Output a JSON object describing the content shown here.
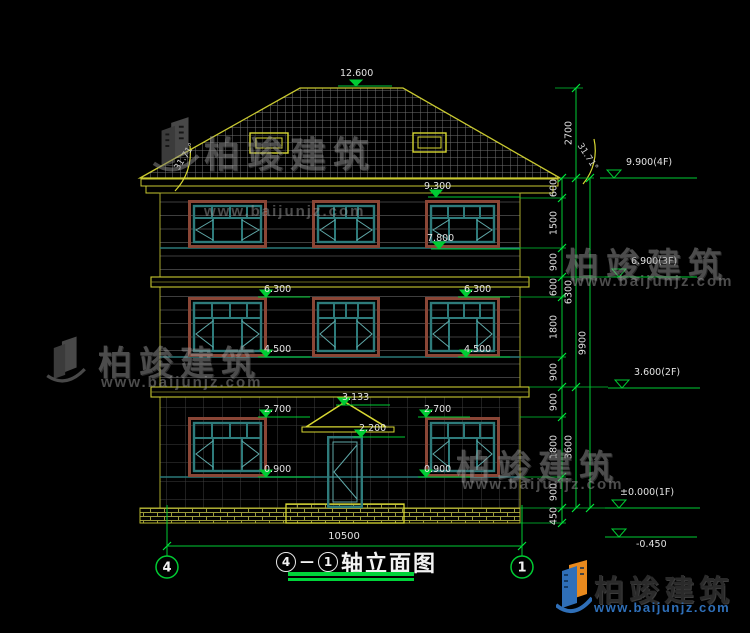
{
  "title": {
    "axis_start": "4",
    "axis_end": "1",
    "separator": "—",
    "name": "轴立面图"
  },
  "axes": {
    "left": "4",
    "right": "1"
  },
  "watermark": {
    "brand": "柏竣建筑",
    "url": "www.baijunjz.com"
  },
  "roof": {
    "ridge_level": "12.600",
    "slope_angle": "31.71°"
  },
  "levels": {
    "win3_head": "9.300",
    "win3_sill": "7.800",
    "win2_head": "6.300",
    "win2_sill": "4.500",
    "canopy_top": "3.133",
    "win1_head": "2.700",
    "door_head": "2.200",
    "win1_sill": "0.900",
    "floor4": "9.900(4F)",
    "floor3": "6.900(3F)",
    "floor2": "3.600(2F)",
    "floor1": "±0.000(1F)",
    "ground": "-0.450"
  },
  "dims": {
    "total_width": "10500",
    "overall_height": "9900",
    "subtotals": [
      "6300",
      "3600"
    ],
    "segments": [
      "2700",
      "600",
      "1500",
      "900",
      "600",
      "1800",
      "900",
      "900",
      "1800",
      "900",
      "450"
    ]
  },
  "colors": {
    "line_yellow": "#c9c930",
    "line_green": "#00cc33",
    "window_teal": "#2e7b7b",
    "frame_brown": "#8a4636",
    "logo_blue": "#2f6fb8",
    "logo_orange": "#e8891d"
  }
}
